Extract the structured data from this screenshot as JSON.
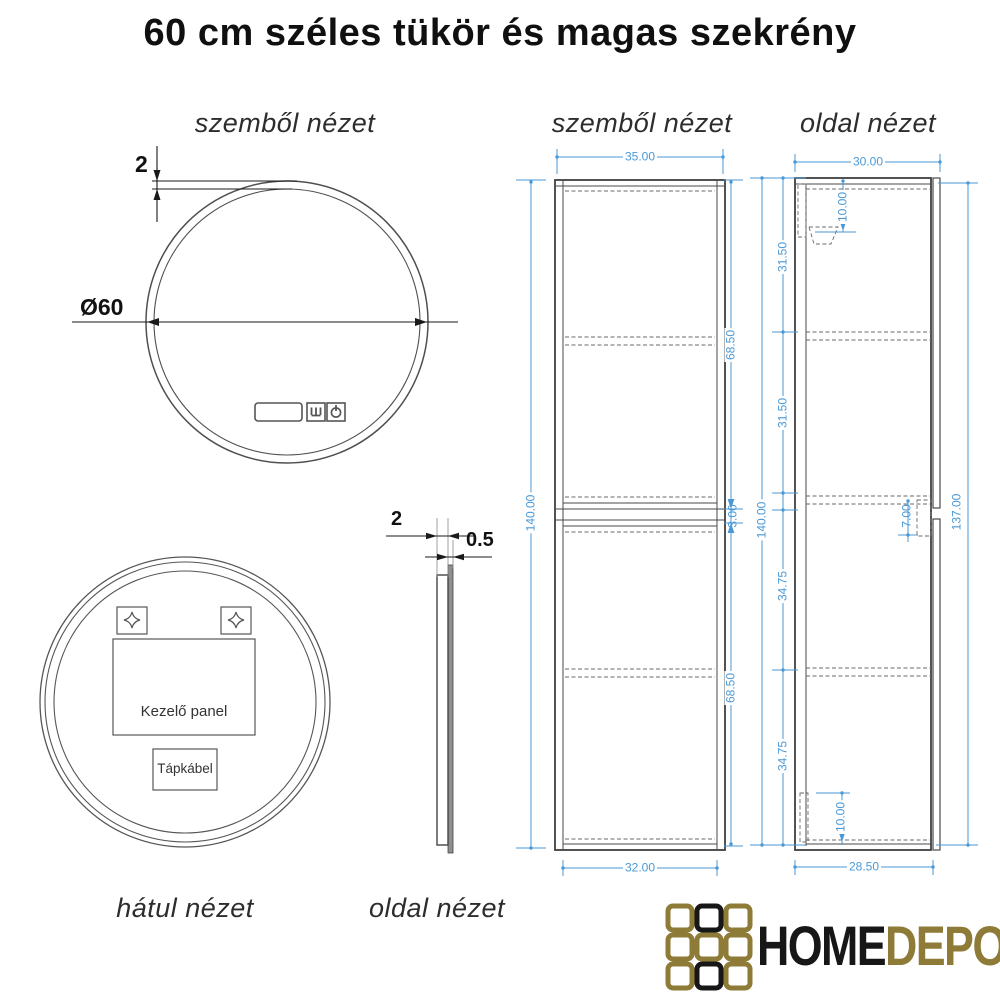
{
  "title": "60 cm széles tükör és magas szekrény",
  "colors": {
    "dimension_blue": "#4a99d6",
    "drawing_line": "#4a4a4a",
    "logo_gold": "#8d7b37",
    "logo_black": "#171717"
  },
  "mirror_front": {
    "label": "szemből nézet",
    "frame_thickness": "2",
    "diameter": "Ø60",
    "icons": [
      "display-icon",
      "defogger-icon",
      "power-icon"
    ]
  },
  "mirror_back": {
    "label": "hátul nézet",
    "control_panel_label": "Kezelő panel",
    "power_cable_label": "Tápkábel"
  },
  "mirror_side": {
    "label": "oldal nézet",
    "frame_depth": "2",
    "glass_thickness": "0.5"
  },
  "cabinet_front": {
    "label": "szemből nézet",
    "width_top": "35.00",
    "width_bottom": "32.00",
    "height": "140.00",
    "upper_section": "68.50",
    "middle_gap": "3.00",
    "lower_section": "68.50"
  },
  "cabinet_side": {
    "label": "oldal nézet",
    "depth_top": "30.00",
    "depth_bottom": "28.50",
    "height": "140.00",
    "height_right": "137.00",
    "segment_1": "31.50",
    "segment_2": "31.50",
    "segment_3": "34.75",
    "segment_4": "34.75",
    "bracket_offset": "10.00",
    "handle_height": "7.00",
    "rail_height": "10.00"
  },
  "logo": {
    "primary": "HOME",
    "secondary": "DEPO"
  }
}
